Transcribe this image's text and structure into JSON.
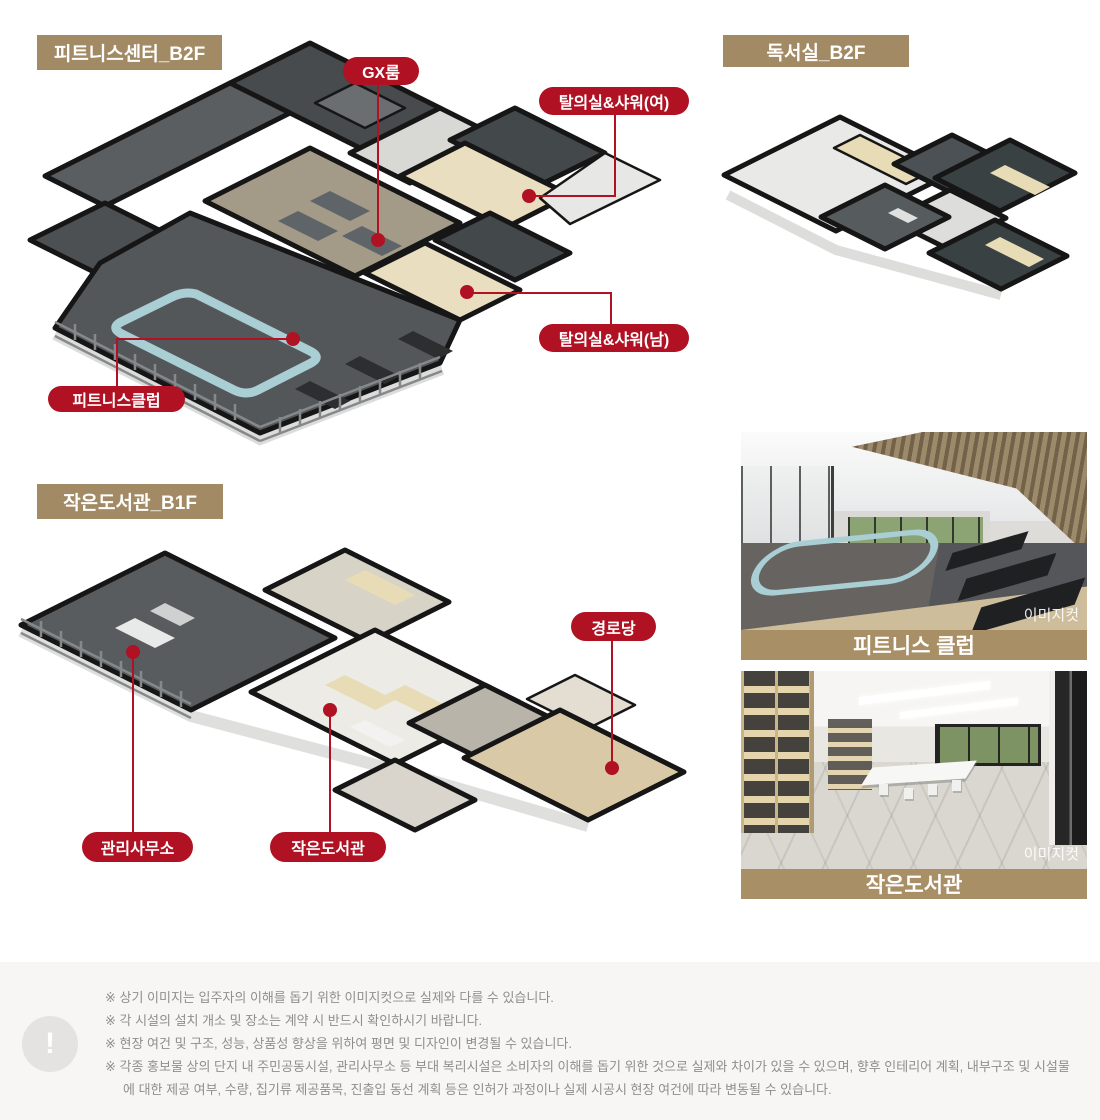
{
  "plans": {
    "fitness": {
      "title": "피트니스센터_B2F",
      "callouts": {
        "gx": "GX룸",
        "shower_w": "탈의실&샤워(여)",
        "shower_m": "탈의실&샤워(남)",
        "club": "피트니스클럽"
      }
    },
    "reading": {
      "title": "독서실_B2F"
    },
    "library": {
      "title": "작은도서관_B1F",
      "callouts": {
        "senior": "경로당",
        "office": "관리사무소",
        "lib": "작은도서관"
      }
    }
  },
  "photos": {
    "fitness": {
      "caption": "피트니스 클럽",
      "watermark": "이미지컷"
    },
    "library": {
      "caption": "작은도서관",
      "watermark": "이미지컷"
    }
  },
  "notice": {
    "icon": "!",
    "lines": [
      "※ 상기 이미지는 입주자의 이해를 돕기 위한 이미지컷으로 실제와 다를 수 있습니다.",
      "※ 각 시설의 설치 개소 및 장소는 계약 시 반드시 확인하시기 바랍니다.",
      "※ 현장 여건 및 구조, 성능, 상품성 향상을 위하여 평면 및 디자인이 변경될 수 있습니다.",
      "※ 각종 홍보물 상의 단지 내 주민공동시설, 관리사무소 등 부대 복리시설은 소비자의 이해를 돕기 위한 것으로 실제와 차이가 있을 수 있으며, 향후 인테리어 계획, 내부구조 및 시설물에 대한 제공 여부, 수량, 집기류 제공품목, 진출입 동선 계획 등은 인허가 과정이나 실제 시공시 현장 여건에 따라 변동될 수 있습니다."
    ]
  },
  "colors": {
    "accent_red": "#b01123",
    "badge_tan": "#a28a64",
    "caption_tan": "#a98f66",
    "notice_bg": "#f7f6f4",
    "track_blue": "#a9ced3"
  }
}
